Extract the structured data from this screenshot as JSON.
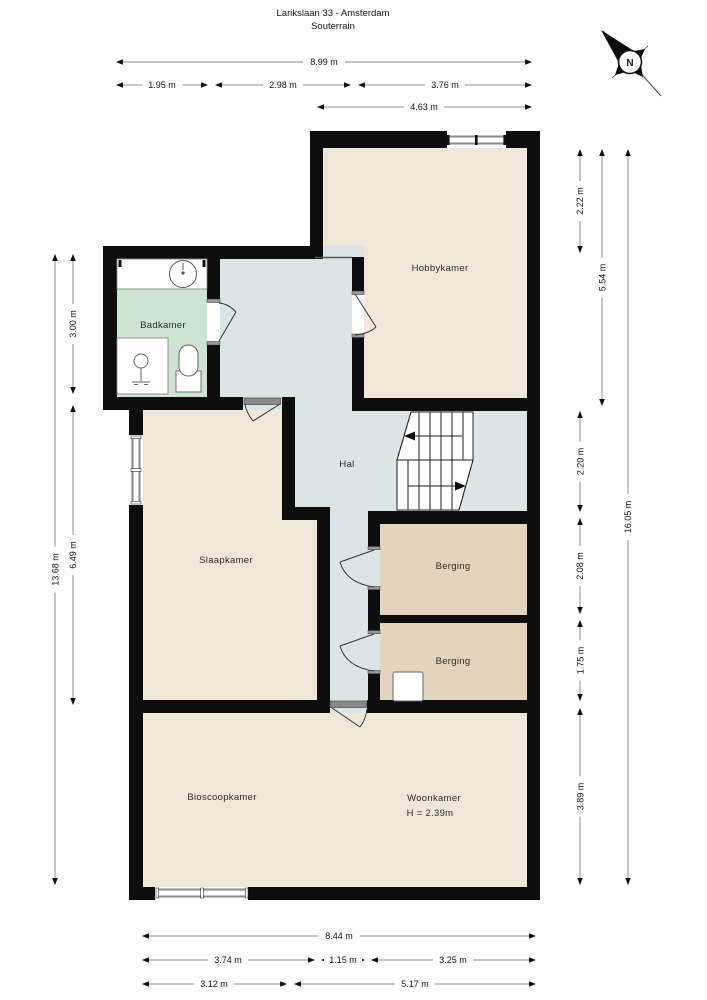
{
  "header": {
    "title": "Larikslaan 33 - Amsterdam",
    "subtitle": "Souterrain"
  },
  "compass": {
    "north_label": "N"
  },
  "rooms": {
    "hobbykamer": "Hobbykamer",
    "badkamer": "Badkamer",
    "hal": "Hal",
    "slaapkamer": "Slaapkamer",
    "berging1": "Berging",
    "berging2": "Berging",
    "bioscoopkamer": "Bioscoopkamer",
    "woonkamer": "Woonkamer",
    "woonkamer_height": "H = 2.39m"
  },
  "dims": {
    "top_total": "8.99 m",
    "top_badkamer": "1.95 m",
    "top_hal": "2.98 m",
    "top_hobbykamer": "3.76 m",
    "top_right_block": "4.63 m",
    "left_total": "13.68 m",
    "left_badkamer": "3.00 m",
    "left_slaapkamer": "6.49 m",
    "right_upper": "2.22 m",
    "right_hobbykamer": "5.54 m",
    "right_total": "16.05 m",
    "right_hal": "2.20 m",
    "right_berging1": "2.08 m",
    "right_berging2": "1.75 m",
    "right_woonkamer": "3.89 m",
    "bottom_total": "8.44 m",
    "bottom_left": "3.74 m",
    "bottom_middle": "1.15 m",
    "bottom_right": "3.25 m",
    "bottom_left2": "3.12 m",
    "bottom_right2": "5.17 m"
  },
  "colors": {
    "wall": "#0d0d0d",
    "room_beige": "#f0e7da",
    "hal_blue": "#dbe5e8",
    "badkamer_green": "#cee3d2",
    "berging_tan": "#e3d5bd",
    "window_gray": "#8a8a8a",
    "dim_line": "#8c8c8c"
  }
}
